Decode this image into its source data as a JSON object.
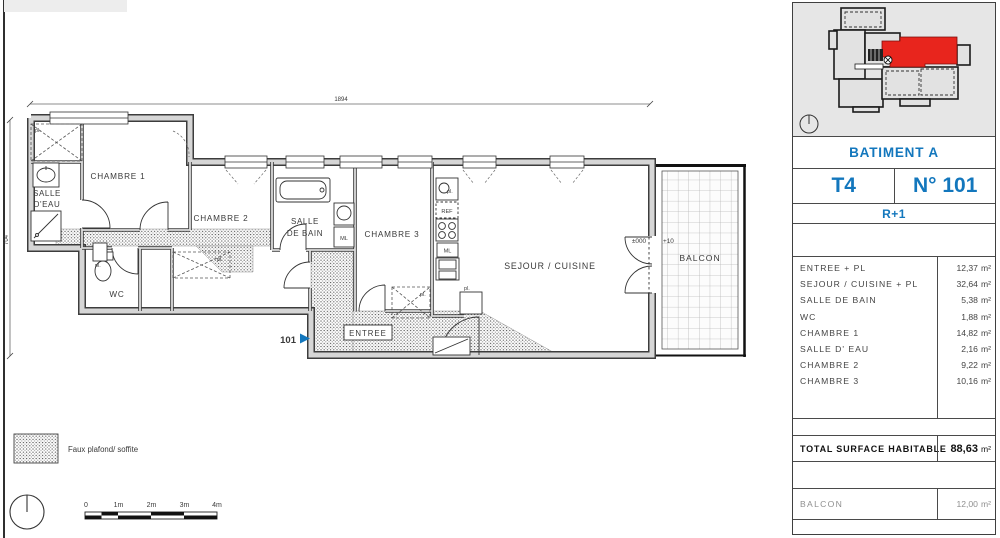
{
  "plan": {
    "room_labels": {
      "chambre1": "CHAMBRE 1",
      "chambre2": "CHAMBRE 2",
      "chambre3": "CHAMBRE 3",
      "salle_deau_1": "SALLE",
      "salle_deau_2": "D'EAU",
      "salle_bain_1": "SALLE",
      "salle_bain_2": "DE BAIN",
      "wc": "WC",
      "sejour": "SEJOUR / CUISINE",
      "entree": "ENTREE",
      "balcon": "BALCON"
    },
    "markers": {
      "unit": "101",
      "level_zero": "±000",
      "level_balcony": "+10",
      "ref": "REF",
      "ml": "ML",
      "pl": "pl."
    },
    "dims": {
      "width": "1894",
      "height": "704"
    },
    "legend_label": "Faux plafond/ soffite",
    "scale_ticks": [
      "0",
      "1m",
      "2m",
      "3m",
      "4m"
    ]
  },
  "panel": {
    "building_label": "BATIMENT A",
    "type_label": "T4",
    "unit_label": "N° 101",
    "floor_label": "R+1",
    "areas": [
      {
        "name": "ENTREE + PL",
        "value": "12,37",
        "unit": "m²"
      },
      {
        "name": "SEJOUR / CUISINE + PL",
        "value": "32,64",
        "unit": "m²"
      },
      {
        "name": "SALLE DE BAIN",
        "value": "5,38",
        "unit": "m²"
      },
      {
        "name": "WC",
        "value": "1,88",
        "unit": "m²"
      },
      {
        "name": "CHAMBRE 1",
        "value": "14,82",
        "unit": "m²"
      },
      {
        "name": "SALLE D' EAU",
        "value": "2,16",
        "unit": "m²"
      },
      {
        "name": "CHAMBRE 2",
        "value": "9,22",
        "unit": "m²"
      },
      {
        "name": "CHAMBRE 3",
        "value": "10,16",
        "unit": "m²"
      }
    ],
    "total": {
      "label": "TOTAL SURFACE HABITABLE",
      "value": "88,63",
      "unit": "m²"
    },
    "balcony": {
      "label": "BALCON",
      "value": "12,00",
      "unit": "m²"
    }
  },
  "colors": {
    "accent_blue": "#1377bd",
    "unit_red": "#e8251d"
  }
}
